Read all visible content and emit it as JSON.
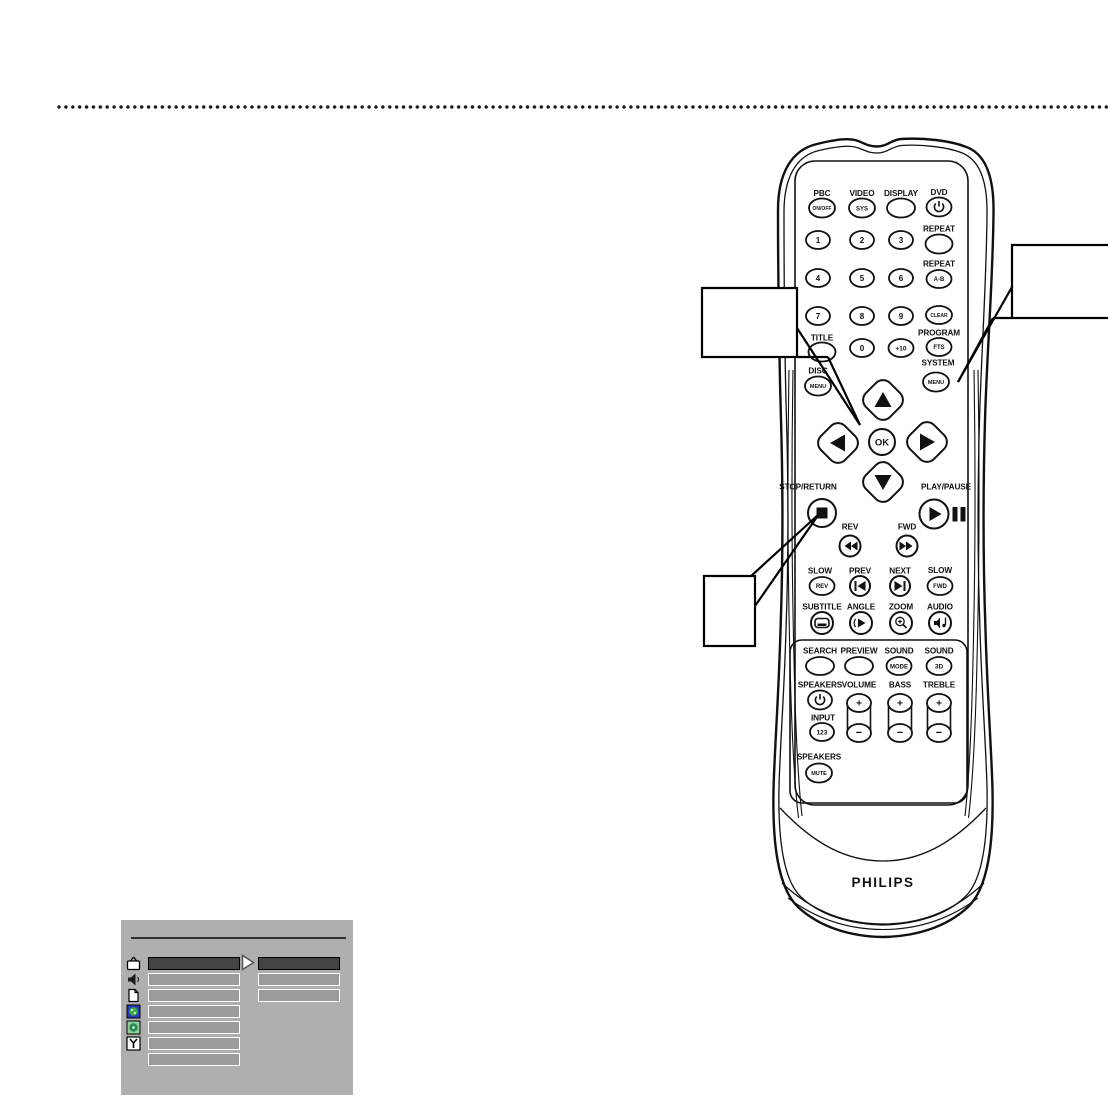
{
  "page": {
    "background": "#ffffff",
    "divider_dot_color": "#1a1a1a"
  },
  "remote": {
    "brand": "PHILIPS",
    "digits": [
      "1",
      "2",
      "3",
      "4",
      "5",
      "6",
      "7",
      "8",
      "9",
      "0",
      "+10"
    ],
    "buttons": {
      "pbc": {
        "label": "PBC",
        "text": "ON/OFF"
      },
      "video": {
        "label": "VIDEO",
        "text": "SYS"
      },
      "display": {
        "label": "DISPLAY"
      },
      "dvd": {
        "label": "DVD"
      },
      "repeat": {
        "label": "REPEAT"
      },
      "repeat_ab": {
        "label": "REPEAT",
        "text": "A-B"
      },
      "clear": {
        "text": "CLEAR"
      },
      "title": {
        "label": "TITLE"
      },
      "program": {
        "label": "PROGRAM",
        "text": "FTS"
      },
      "disc_menu": {
        "label": "DISC",
        "text": "MENU"
      },
      "system_menu": {
        "label": "SYSTEM",
        "text": "MENU"
      },
      "ok": {
        "text": "OK"
      },
      "stop_return": {
        "label": "STOP/RETURN"
      },
      "play_pause": {
        "label": "PLAY/PAUSE"
      },
      "rev": {
        "label": "REV"
      },
      "fwd": {
        "label": "FWD"
      },
      "slow_rev": {
        "label": "SLOW",
        "text": "REV"
      },
      "prev": {
        "label": "PREV"
      },
      "next": {
        "label": "NEXT"
      },
      "slow_fwd": {
        "label": "SLOW",
        "text": "FWD"
      },
      "subtitle": {
        "label": "SUBTITLE"
      },
      "angle": {
        "label": "ANGLE"
      },
      "zoom": {
        "label": "ZOOM"
      },
      "audio": {
        "label": "AUDIO"
      },
      "search": {
        "label": "SEARCH"
      },
      "preview": {
        "label": "PREVIEW"
      },
      "sound_mode": {
        "label": "SOUND",
        "text": "MODE"
      },
      "sound_3d": {
        "label": "SOUND",
        "text": "3D"
      },
      "speakers_power": {
        "label": "SPEAKERS"
      },
      "volume": {
        "label": "VOLUME",
        "plus": "+",
        "minus": "−"
      },
      "bass": {
        "label": "BASS",
        "plus": "+",
        "minus": "−"
      },
      "treble": {
        "label": "TREBLE",
        "plus": "+",
        "minus": "−"
      },
      "input": {
        "label": "INPUT",
        "text": "123"
      },
      "speakers_mute": {
        "label": "SPEAKERS",
        "text": "MUTE"
      }
    }
  },
  "callouts": [
    {
      "id": "callout-ok",
      "text": "",
      "points_to": "ok-button"
    },
    {
      "id": "callout-system-menu",
      "text": "",
      "points_to": "system-menu-button"
    },
    {
      "id": "callout-stop-return",
      "text": "",
      "points_to": "stop-return-button"
    }
  ],
  "osd_menu": {
    "background": "#afafaf",
    "highlight_color": "#434343",
    "bar_color": "#9b9b9b",
    "left_rows": 7,
    "right_rows": 3,
    "icons": [
      "tv-icon",
      "speaker-icon",
      "page-icon",
      "access-icon",
      "disc-icon",
      "setup-wrench-icon"
    ]
  }
}
